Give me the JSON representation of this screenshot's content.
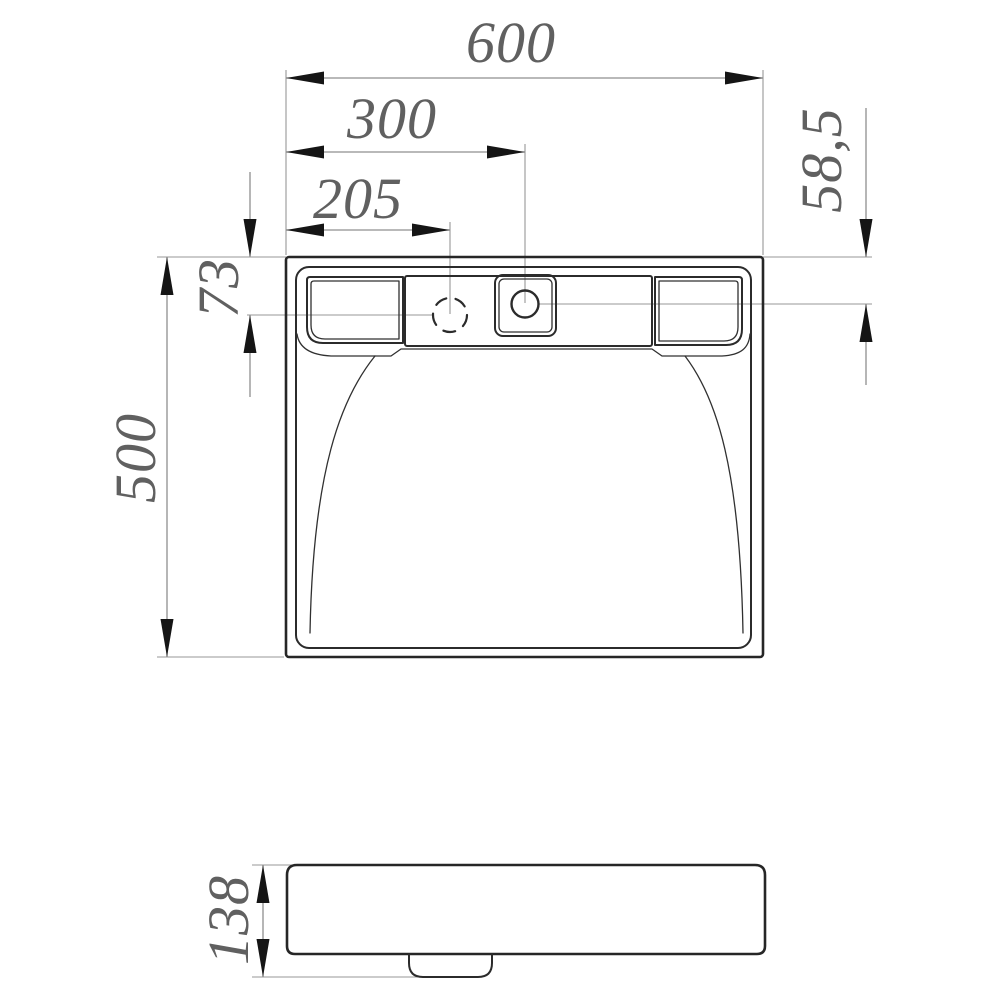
{
  "dimension_labels": {
    "overall_width": "600",
    "main_hole_offset_x": "300",
    "second_hole_offset_x": "205",
    "main_hole_offset_y": "58,5",
    "second_hole_offset_y": "73",
    "overall_depth": "500",
    "profile_height": "138"
  },
  "colors": {
    "outline": "#262626",
    "dimension_line": "#8f8f8f",
    "arrowhead": "#151515",
    "dimension_text": "#606060",
    "background": "#ffffff"
  }
}
